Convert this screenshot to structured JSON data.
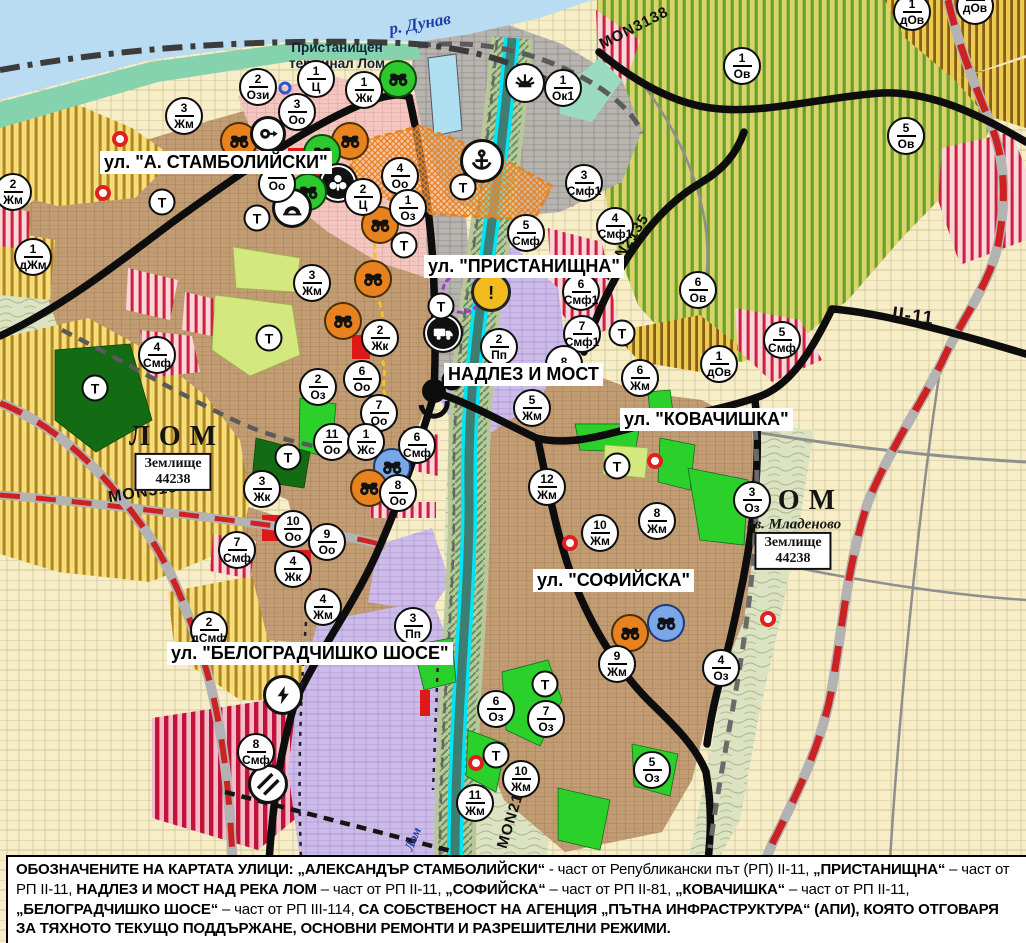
{
  "colors": {
    "water": "#b9dcf2",
    "shore_green": "#84d2ae",
    "urban_brown": "#c29c73",
    "park_green": "#2bd02b",
    "dark_green": "#136b13",
    "light_green": "#d3e97f",
    "production_lavender": "#cdbce9",
    "mixed_red_stripe": "#cb1f3a",
    "vineyard_stripe": "#63a22c",
    "yellow_stripe": "#b1861c",
    "road_black": "#0d0d0d",
    "road_red_dash": "#cc2222",
    "river_cyan": "#00e4f6",
    "warning_yellow": "#f2bb1d",
    "monument_orange": "#e8821e",
    "monument_green": "#2ec82e",
    "monument_blue": "#79a7e8"
  },
  "labels": {
    "street": [
      {
        "name": "street-label-stambolijski",
        "text": "ул. \"А. СТАМБОЛИЙСКИ\"",
        "x": 100,
        "y": 151
      },
      {
        "name": "street-label-pristanishtna",
        "text": "ул. \"ПРИСТАНИЩНА\"",
        "x": 424,
        "y": 255
      },
      {
        "name": "street-label-nadlez-i-most",
        "text": "НАДЛЕЗ И МОСТ",
        "x": 444,
        "y": 363
      },
      {
        "name": "street-label-kovachishka",
        "text": "ул. \"КОВАЧИШКА\"",
        "x": 620,
        "y": 408
      },
      {
        "name": "street-label-sofijska",
        "text": "ул. \"СОФИЙСКА\"",
        "x": 533,
        "y": 569
      },
      {
        "name": "street-label-belogradchishko",
        "text": "ул. \"БЕЛОГРАДЧИШКО ШОСЕ\"",
        "x": 167,
        "y": 642
      }
    ],
    "city": [
      {
        "name": "city-label-lom-west",
        "text": "ЛОМ",
        "x": 177,
        "y": 437
      },
      {
        "name": "city-label-lom-east",
        "text": "ЛОМ",
        "x": 796,
        "y": 501
      }
    ],
    "district": [
      {
        "name": "district-label-mladenovo",
        "text": "кв. Младеново",
        "x": 794,
        "y": 525
      }
    ],
    "landboxes": [
      {
        "name": "land-box-west",
        "line1": "Землище",
        "line2": "44238",
        "x": 173,
        "y": 472
      },
      {
        "name": "land-box-east",
        "line1": "Землище",
        "line2": "44238",
        "x": 793,
        "y": 551
      }
    ],
    "rivers": [
      {
        "name": "river-label-dunav",
        "text": "р. Дунав",
        "x": 420,
        "y": 24,
        "rotate": -10,
        "size": 17
      },
      {
        "name": "river-label-lom",
        "text": "Лом",
        "x": 413,
        "y": 839,
        "rotate": -68,
        "size": 13
      }
    ],
    "terminal": {
      "name": "terminal-label",
      "line1": "Пристанищен",
      "line2": "терминал Лом",
      "x": 337,
      "y": 56
    },
    "roads": [
      {
        "name": "road-label-mon3139",
        "text": "MON3139",
        "x": 148,
        "y": 492,
        "rotate": -9,
        "size": 16
      },
      {
        "name": "road-label-mon3138",
        "text": "MON3138",
        "x": 634,
        "y": 28,
        "rotate": -27,
        "size": 15
      },
      {
        "name": "road-label-mon2135",
        "text": "MON2135",
        "x": 625,
        "y": 247,
        "rotate": -57,
        "size": 15
      },
      {
        "name": "road-label-mon2136",
        "text": "MON2136",
        "x": 513,
        "y": 812,
        "rotate": -73,
        "size": 15
      },
      {
        "name": "road-label-ii-11",
        "text": "II-11",
        "x": 913,
        "y": 317,
        "rotate": 7,
        "size": 19
      }
    ]
  },
  "markers": {
    "zones": [
      {
        "x": 258,
        "y": 87,
        "num": "2",
        "code": "Ози"
      },
      {
        "x": 316,
        "y": 79,
        "num": "1",
        "code": "Ц"
      },
      {
        "x": 364,
        "y": 90,
        "num": "1",
        "code": "Жк"
      },
      {
        "x": 297,
        "y": 112,
        "num": "3",
        "code": "Оо"
      },
      {
        "x": 184,
        "y": 116,
        "num": "3",
        "code": "Жм"
      },
      {
        "x": 13,
        "y": 192,
        "num": "2",
        "code": "Жм"
      },
      {
        "x": 33,
        "y": 257,
        "num": "1",
        "code": "дЖм"
      },
      {
        "x": 400,
        "y": 176,
        "num": "4",
        "code": "Оо"
      },
      {
        "x": 363,
        "y": 197,
        "num": "2",
        "code": "Ц"
      },
      {
        "x": 408,
        "y": 208,
        "num": "1",
        "code": "Оз"
      },
      {
        "x": 277,
        "y": 184,
        "num": "",
        "code": "Оо"
      },
      {
        "x": 312,
        "y": 283,
        "num": "3",
        "code": "Жм"
      },
      {
        "x": 380,
        "y": 338,
        "num": "2",
        "code": "Жк"
      },
      {
        "x": 318,
        "y": 387,
        "num": "2",
        "code": "Оз"
      },
      {
        "x": 362,
        "y": 379,
        "num": "6",
        "code": "Оо"
      },
      {
        "x": 379,
        "y": 413,
        "num": "7",
        "code": "Оо"
      },
      {
        "x": 332,
        "y": 442,
        "num": "11",
        "code": "Оо"
      },
      {
        "x": 366,
        "y": 442,
        "num": "1",
        "code": "Жс"
      },
      {
        "x": 417,
        "y": 445,
        "num": "6",
        "code": "Смф"
      },
      {
        "x": 262,
        "y": 489,
        "num": "3",
        "code": "Жк"
      },
      {
        "x": 398,
        "y": 493,
        "num": "8",
        "code": "Оо"
      },
      {
        "x": 293,
        "y": 529,
        "num": "10",
        "code": "Оо"
      },
      {
        "x": 327,
        "y": 542,
        "num": "9",
        "code": "Оо"
      },
      {
        "x": 293,
        "y": 569,
        "num": "4",
        "code": "Жк"
      },
      {
        "x": 323,
        "y": 607,
        "num": "4",
        "code": "Жм"
      },
      {
        "x": 413,
        "y": 626,
        "num": "3",
        "code": "Пп"
      },
      {
        "x": 209,
        "y": 630,
        "num": "2",
        "code": "дСмф"
      },
      {
        "x": 237,
        "y": 550,
        "num": "7",
        "code": "Смф"
      },
      {
        "x": 157,
        "y": 355,
        "num": "4",
        "code": "Смф"
      },
      {
        "x": 256,
        "y": 752,
        "num": "8",
        "code": "Смф"
      },
      {
        "x": 563,
        "y": 88,
        "num": "1",
        "code": "Ок1"
      },
      {
        "x": 584,
        "y": 183,
        "num": "3",
        "code": "Смф1"
      },
      {
        "x": 526,
        "y": 233,
        "num": "5",
        "code": "Смф"
      },
      {
        "x": 615,
        "y": 226,
        "num": "4",
        "code": "Смф1"
      },
      {
        "x": 499,
        "y": 347,
        "num": "2",
        "code": "Пп"
      },
      {
        "x": 581,
        "y": 292,
        "num": "6",
        "code": "Смф1"
      },
      {
        "x": 582,
        "y": 334,
        "num": "7",
        "code": "Смф1"
      },
      {
        "x": 564,
        "y": 364,
        "num": "8",
        "code": ""
      },
      {
        "x": 532,
        "y": 408,
        "num": "5",
        "code": "Жм"
      },
      {
        "x": 640,
        "y": 378,
        "num": "6",
        "code": "Жм"
      },
      {
        "x": 719,
        "y": 364,
        "num": "1",
        "code": "дОв"
      },
      {
        "x": 547,
        "y": 487,
        "num": "12",
        "code": "Жм"
      },
      {
        "x": 600,
        "y": 533,
        "num": "10",
        "code": "Жм"
      },
      {
        "x": 657,
        "y": 521,
        "num": "8",
        "code": "Жм"
      },
      {
        "x": 752,
        "y": 500,
        "num": "3",
        "code": "Оз"
      },
      {
        "x": 617,
        "y": 664,
        "num": "9",
        "code": "Жм"
      },
      {
        "x": 496,
        "y": 709,
        "num": "6",
        "code": "Оз"
      },
      {
        "x": 546,
        "y": 719,
        "num": "7",
        "code": "Оз"
      },
      {
        "x": 521,
        "y": 779,
        "num": "10",
        "code": "Жм"
      },
      {
        "x": 475,
        "y": 803,
        "num": "11",
        "code": "Жм"
      },
      {
        "x": 652,
        "y": 770,
        "num": "5",
        "code": "Оз"
      },
      {
        "x": 721,
        "y": 668,
        "num": "4",
        "code": "Оз"
      },
      {
        "x": 742,
        "y": 66,
        "num": "1",
        "code": "Ов"
      },
      {
        "x": 912,
        "y": 12,
        "num": "1",
        "code": "дОв"
      },
      {
        "x": 975,
        "y": 6,
        "num": "",
        "code": "дОв"
      },
      {
        "x": 906,
        "y": 136,
        "num": "5",
        "code": "Ов"
      },
      {
        "x": 698,
        "y": 290,
        "num": "6",
        "code": "Ов"
      },
      {
        "x": 782,
        "y": 340,
        "num": "5",
        "code": "Смф"
      }
    ],
    "transport": [
      {
        "x": 162,
        "y": 202
      },
      {
        "x": 257,
        "y": 218
      },
      {
        "x": 404,
        "y": 245
      },
      {
        "x": 269,
        "y": 338
      },
      {
        "x": 288,
        "y": 457
      },
      {
        "x": 95,
        "y": 388
      },
      {
        "x": 463,
        "y": 187
      },
      {
        "x": 441,
        "y": 306
      },
      {
        "x": 622,
        "y": 333
      },
      {
        "x": 617,
        "y": 466
      },
      {
        "x": 545,
        "y": 684
      },
      {
        "x": 496,
        "y": 755
      }
    ],
    "transport_letter": "Т",
    "pois": [
      {
        "x": 398,
        "y": 79,
        "type": "monument-green"
      },
      {
        "x": 239,
        "y": 141,
        "type": "monument-orange"
      },
      {
        "x": 268,
        "y": 134,
        "type": "key"
      },
      {
        "x": 350,
        "y": 141,
        "type": "monument-orange"
      },
      {
        "x": 322,
        "y": 153,
        "type": "monument-green"
      },
      {
        "x": 338,
        "y": 183,
        "type": "trefoil"
      },
      {
        "x": 308,
        "y": 192,
        "type": "monument-green"
      },
      {
        "x": 292,
        "y": 208,
        "type": "tunnel"
      },
      {
        "x": 380,
        "y": 225,
        "type": "monument-orange"
      },
      {
        "x": 373,
        "y": 279,
        "type": "monument-orange"
      },
      {
        "x": 343,
        "y": 321,
        "type": "monument-orange"
      },
      {
        "x": 392,
        "y": 467,
        "type": "monument-blue"
      },
      {
        "x": 369,
        "y": 488,
        "type": "monument-orange"
      },
      {
        "x": 525,
        "y": 83,
        "type": "fan"
      },
      {
        "x": 482,
        "y": 161,
        "type": "anchor"
      },
      {
        "x": 443,
        "y": 333,
        "type": "truck"
      },
      {
        "x": 491,
        "y": 292,
        "type": "warning"
      },
      {
        "x": 283,
        "y": 695,
        "type": "bolt"
      },
      {
        "x": 268,
        "y": 784,
        "type": "crossing"
      },
      {
        "x": 630,
        "y": 633,
        "type": "monument-orange"
      },
      {
        "x": 666,
        "y": 623,
        "type": "monument-blue"
      },
      {
        "x": 462,
        "y": 293,
        "type": "boundary-circle"
      }
    ],
    "dots": [
      {
        "x": 120,
        "y": 139,
        "kind": "red"
      },
      {
        "x": 103,
        "y": 193,
        "kind": "red"
      },
      {
        "x": 570,
        "y": 543,
        "kind": "red"
      },
      {
        "x": 655,
        "y": 461,
        "kind": "red"
      },
      {
        "x": 768,
        "y": 619,
        "kind": "red"
      },
      {
        "x": 476,
        "y": 763,
        "kind": "red"
      },
      {
        "x": 285,
        "y": 88,
        "kind": "blue"
      }
    ]
  },
  "note": {
    "segments": [
      {
        "b": true,
        "t": "ОБОЗНАЧЕНИТЕ НА КАРТАТА УЛИЦИ: „АЛЕКСАНДЪР СТАМБОЛИЙСКИ“"
      },
      {
        "b": false,
        "t": " - част от Републикански път (РП) II-11, "
      },
      {
        "b": true,
        "t": "„ПРИСТАНИЩНА“"
      },
      {
        "b": false,
        "t": " – част от РП II-11, "
      },
      {
        "b": true,
        "t": "НАДЛЕЗ И МОСТ НАД РЕКА ЛОМ"
      },
      {
        "b": false,
        "t": " – част от РП II-11, "
      },
      {
        "b": true,
        "t": "„СОФИЙСКА“"
      },
      {
        "b": false,
        "t": " – част от РП II-81, "
      },
      {
        "b": true,
        "t": "„КОВАЧИШКА“"
      },
      {
        "b": false,
        "t": " – част от РП II-11, "
      },
      {
        "b": true,
        "t": "„БЕЛОГРАДЧИШКО ШОСЕ“"
      },
      {
        "b": false,
        "t": " – част от РП III-114, "
      },
      {
        "b": true,
        "t": "СА СОБСТВЕНОСТ НА АГЕНЦИЯ „ПЪТНА ИНФРАСТРУКТУРА“ (АПИ), КОЯТО ОТГОВАРЯ ЗА ТЯХНОТО ТЕКУЩО ПОДДЪРЖАНЕ, ОСНОВНИ РЕМОНТИ И РАЗРЕШИТЕЛНИ РЕЖИМИ."
      }
    ]
  }
}
